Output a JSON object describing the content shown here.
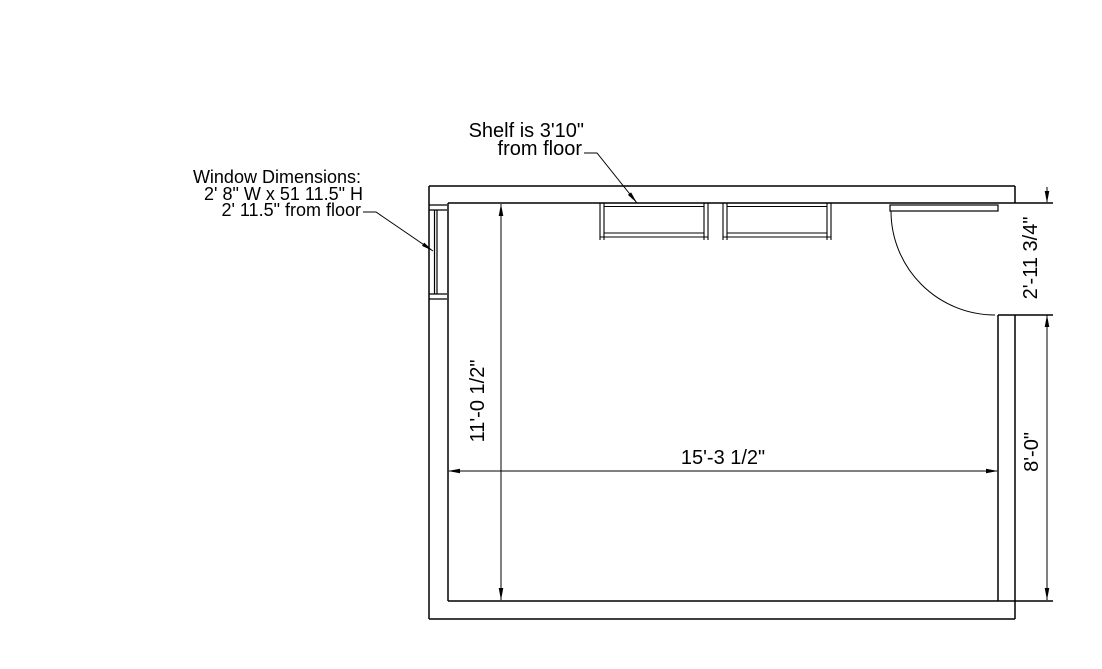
{
  "drawing_type": "room-floor-plan",
  "annotations": {
    "shelf_note": {
      "line1": "Shelf is 3'10\"",
      "line2": "from floor"
    },
    "window_note": {
      "line1": "Window Dimensions:",
      "line2": "2' 8\" W x 51 11.5\" H",
      "line3": "2' 11.5\" from floor"
    }
  },
  "dimensions": {
    "room_width": "15'-3 1/2\"",
    "room_height": "11'-0 1/2\"",
    "door_opening_height": "2'-11 3/4\"",
    "wall_below_door": "8'-0\""
  },
  "colors": {
    "line": "#000000",
    "background": "#ffffff"
  }
}
